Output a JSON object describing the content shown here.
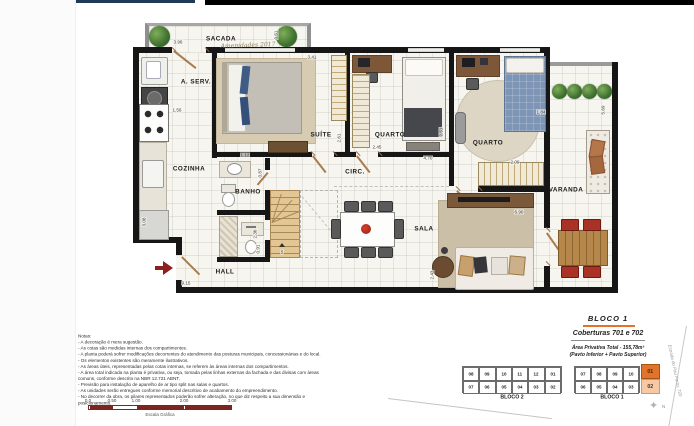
{
  "header": {
    "navy_bar": "#1e3a56",
    "black_bar": "#000000"
  },
  "plan": {
    "room_labels": [
      {
        "label": "SACADA",
        "x": 221,
        "y": 39
      },
      {
        "label": "A. SERV.",
        "x": 196,
        "y": 82
      },
      {
        "label": "COZINHA",
        "x": 189,
        "y": 169
      },
      {
        "label": "SUÍTE",
        "x": 321,
        "y": 135
      },
      {
        "label": "QUARTO",
        "x": 390,
        "y": 135
      },
      {
        "label": "QUARTO",
        "x": 488,
        "y": 143
      },
      {
        "label": "CIRC.",
        "x": 355,
        "y": 172
      },
      {
        "label": "BANHO",
        "x": 248,
        "y": 192
      },
      {
        "label": "SALA",
        "x": 424,
        "y": 229
      },
      {
        "label": "HALL",
        "x": 225,
        "y": 272
      },
      {
        "label": "VARANDA",
        "x": 566,
        "y": 190
      }
    ],
    "dimensions": [
      {
        "v": "3.96",
        "x": 178,
        "y": 42,
        "r": 0
      },
      {
        "v": "0.51",
        "x": 276,
        "y": 35,
        "r": 1
      },
      {
        "v": "3.41",
        "x": 312,
        "y": 57,
        "r": 0
      },
      {
        "v": "2.61",
        "x": 339,
        "y": 138,
        "r": 1
      },
      {
        "v": "2.45",
        "x": 377,
        "y": 147,
        "r": 0
      },
      {
        "v": "2.51",
        "x": 441,
        "y": 132,
        "r": 1
      },
      {
        "v": "4.70",
        "x": 428,
        "y": 158,
        "r": 0
      },
      {
        "v": "2.09",
        "x": 515,
        "y": 162,
        "r": 0
      },
      {
        "v": "1.12",
        "x": 245,
        "y": 155,
        "r": 0
      },
      {
        "v": "0.87",
        "x": 260,
        "y": 173,
        "r": 1
      },
      {
        "v": "1.56",
        "x": 177,
        "y": 110,
        "r": 0
      },
      {
        "v": "3.08",
        "x": 144,
        "y": 222,
        "r": 1
      },
      {
        "v": "2.36",
        "x": 255,
        "y": 234,
        "r": 1
      },
      {
        "v": "0.91",
        "x": 258,
        "y": 249,
        "r": 1
      },
      {
        "v": "9.15",
        "x": 186,
        "y": 283,
        "r": 0
      },
      {
        "v": "6.90",
        "x": 519,
        "y": 212,
        "r": 0
      },
      {
        "v": "2.43",
        "x": 432,
        "y": 275,
        "r": 1
      },
      {
        "v": "1.84",
        "x": 541,
        "y": 112,
        "r": 0
      },
      {
        "v": "5.69",
        "x": 603,
        "y": 110,
        "r": 1
      }
    ],
    "stairs_label": "5",
    "watermark": "Amenidades 2017",
    "entrance_arrow_color": "#8e1f1f"
  },
  "notes": {
    "title": "Notas:",
    "items": [
      "A decoração é mera sugestão.",
      "As cotas são medidas internas dos compartimentos.",
      "A planta poderá sofrer modificações decorrentes do atendimento das posturas municipais, concessionárias e do local.",
      "Os elementos existentes são meramente ilustrativos.",
      "As áreas úteis, representadas pelas cotas internas, se referem às áreas internas dos compartimentos.",
      "A área total indicada na planta é privativa, ou seja, tomada pelas linhas externas da fachada e das divisas com áreas comuns, conforme descrito na NBR 12.721 ABNT.",
      "Previsão para instalação de aparelho de ar tipo split nas salas e quartos.",
      "As unidades serão entregues conforme memorial descritivo de acabamento do empreendimento.",
      "No decorrer da obra, os pilares representados poderão sofrer alteração, no que diz respeito a sua dimensão e posicionamento."
    ]
  },
  "scale": {
    "ticks": [
      {
        "label": "0.0",
        "pct": 0
      },
      {
        "label": "0.50",
        "pct": 16.7
      },
      {
        "label": "1.00",
        "pct": 33.3
      },
      {
        "label": "2.00",
        "pct": 66.7
      },
      {
        "label": "3.00",
        "pct": 100
      }
    ],
    "segments": [
      {
        "from": 0,
        "to": 16.7,
        "filled": true
      },
      {
        "from": 16.7,
        "to": 33.3,
        "filled": false
      },
      {
        "from": 33.3,
        "to": 66.7,
        "filled": true
      },
      {
        "from": 66.7,
        "to": 100,
        "filled": true
      }
    ],
    "caption": "Escala Gráfica",
    "color": "#7c2420"
  },
  "info": {
    "bloco": "BLOCO 1",
    "unidades": "Coberturas 701 e 702",
    "area": "Área Privativa Total - 155,78m²",
    "pavimentos": "(Pavto Inferior + Pavto Superior)",
    "accent": "#e0742c"
  },
  "keyplan": {
    "bloco2": {
      "label": "BLOCO 2",
      "top": [
        "08",
        "09",
        "10",
        "11",
        "12",
        "01"
      ],
      "bottom": [
        "07",
        "06",
        "05",
        "04",
        "03",
        "02"
      ]
    },
    "bloco1": {
      "label": "BLOCO 1",
      "top": [
        "07",
        "08",
        "09",
        "10"
      ],
      "bottom": [
        "06",
        "05",
        "04",
        "03"
      ]
    },
    "highlight": {
      "top": "01",
      "bottom": "02",
      "top_color": "#e0742c",
      "bottom_color": "#f6c9a4"
    },
    "street": "Estrada do Pau Ferro, 720",
    "compass": "N"
  }
}
